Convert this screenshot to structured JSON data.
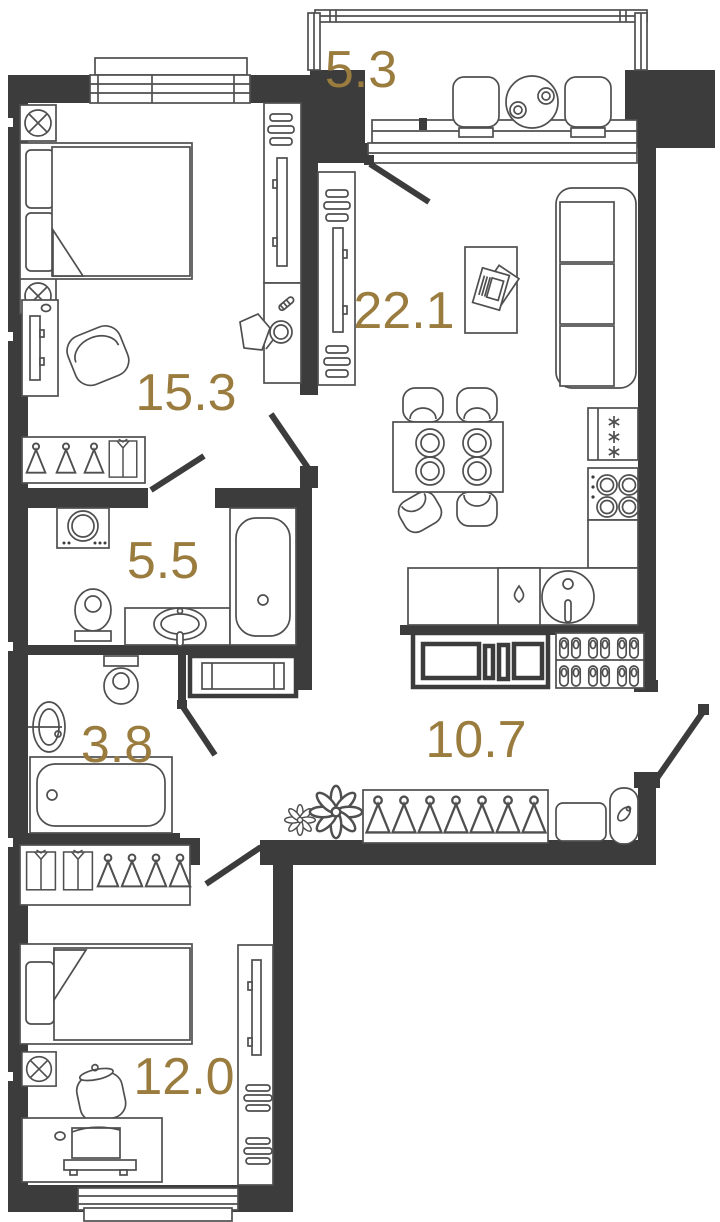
{
  "plan": {
    "accent_color": "#9b7c3f",
    "wall_color": "#3c3c3c",
    "line_color": "#4f4f4f",
    "rooms": [
      {
        "name": "balcony",
        "area": "5.3"
      },
      {
        "name": "living-kitchen",
        "area": "22.1"
      },
      {
        "name": "bedroom-1",
        "area": "15.3"
      },
      {
        "name": "bathroom",
        "area": "5.5"
      },
      {
        "name": "toilet",
        "area": "3.8"
      },
      {
        "name": "hallway",
        "area": "10.7"
      },
      {
        "name": "bedroom-2",
        "area": "12.0"
      }
    ]
  }
}
